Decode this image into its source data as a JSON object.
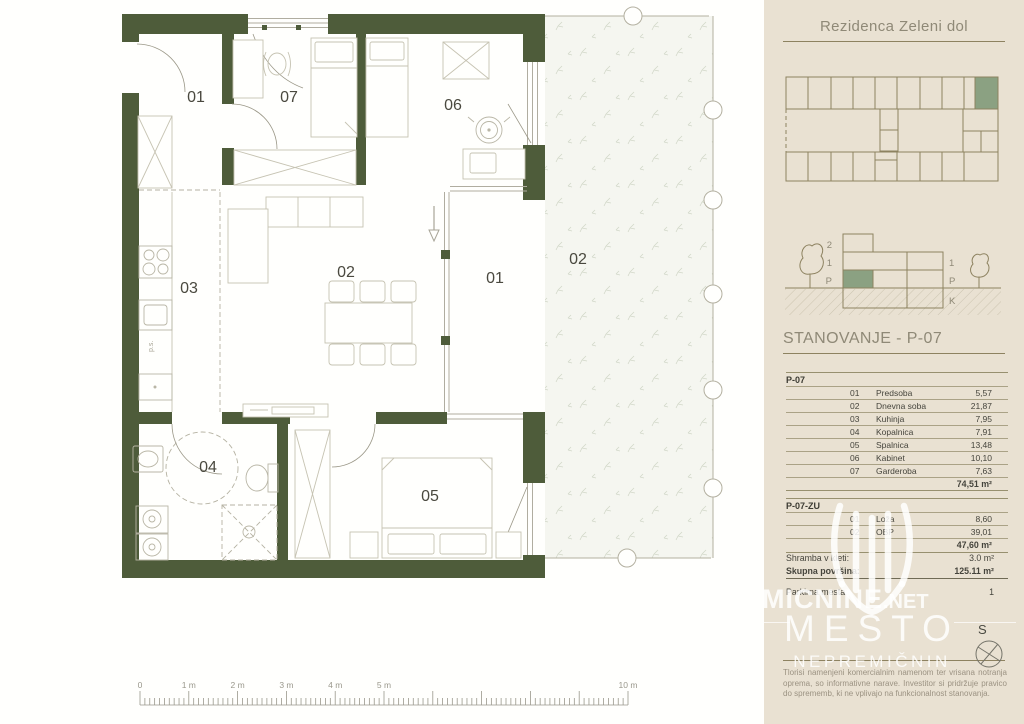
{
  "colors": {
    "wall_green": "#4e5c3a",
    "sidebar_bg": "#e9e1d2",
    "line_olive": "#8d8260",
    "highlight_green": "#8ba182",
    "muted_text": "#8f8977",
    "table_text": "#45443c"
  },
  "sidebar": {
    "project_title": "Rezidenca Zeleni dol",
    "unit_title": "STANOVANJE - P-07",
    "section_floor_labels": {
      "left": [
        "2",
        "1",
        "P"
      ],
      "right": [
        "1",
        "P",
        "K"
      ]
    },
    "area_groups": [
      {
        "name": "P-07",
        "rows": [
          [
            "01",
            "Predsoba",
            "5,57"
          ],
          [
            "02",
            "Dnevna soba",
            "21,87"
          ],
          [
            "03",
            "Kuhinja",
            "7,95"
          ],
          [
            "04",
            "Kopalnica",
            "7,91"
          ],
          [
            "05",
            "Spalnica",
            "13,48"
          ],
          [
            "06",
            "Kabinet",
            "10,10"
          ],
          [
            "07",
            "Garderoba",
            "7,63"
          ]
        ],
        "total": "74,51 m²"
      },
      {
        "name": "P-07-ZU",
        "rows": [
          [
            "01",
            "Loža",
            "8,60"
          ],
          [
            "02",
            "OBP",
            "39,01"
          ]
        ],
        "total": "47,60 m²"
      }
    ],
    "summary": [
      {
        "label": "Shramba v kleti:",
        "value": "3.0 m²",
        "bold": false
      },
      {
        "label": "Skupna površina:",
        "value": "125.11 m²",
        "bold": true
      },
      {
        "label": "Parkirna mesta:",
        "value": "1",
        "bold": false
      }
    ],
    "watermark": {
      "domain_big": "MICNINE",
      "domain_small": ".NET",
      "line2": "MESTO",
      "line3": "NEPREMIČNIN"
    },
    "north_label": "S",
    "disclaimer": "Tlorisi namenjeni komercialnim namenom ter vrisana notranja oprema, so informativne narave. Investitor si pridržuje pravico do sprememb, ki ne vplivajo na funkcionalnost stanovanja."
  },
  "plan": {
    "room_labels": [
      {
        "text": "01",
        "x": 196,
        "y": 102
      },
      {
        "text": "07",
        "x": 289,
        "y": 102
      },
      {
        "text": "06",
        "x": 453,
        "y": 110
      },
      {
        "text": "03",
        "x": 189,
        "y": 293
      },
      {
        "text": "02",
        "x": 346,
        "y": 277
      },
      {
        "text": "01",
        "x": 495,
        "y": 283
      },
      {
        "text": "02",
        "x": 578,
        "y": 264
      },
      {
        "text": "04",
        "x": 208,
        "y": 472
      },
      {
        "text": "05",
        "x": 430,
        "y": 501
      }
    ],
    "ps_label": "p.s.",
    "scale": {
      "labels": [
        {
          "label": "0",
          "meter": 0
        },
        {
          "label": "1 m",
          "meter": 1
        },
        {
          "label": "2 m",
          "meter": 2
        },
        {
          "label": "3 m",
          "meter": 3
        },
        {
          "label": "4 m",
          "meter": 4
        },
        {
          "label": "5 m",
          "meter": 5
        },
        {
          "label": "10 m",
          "meter": 10
        }
      ]
    }
  }
}
